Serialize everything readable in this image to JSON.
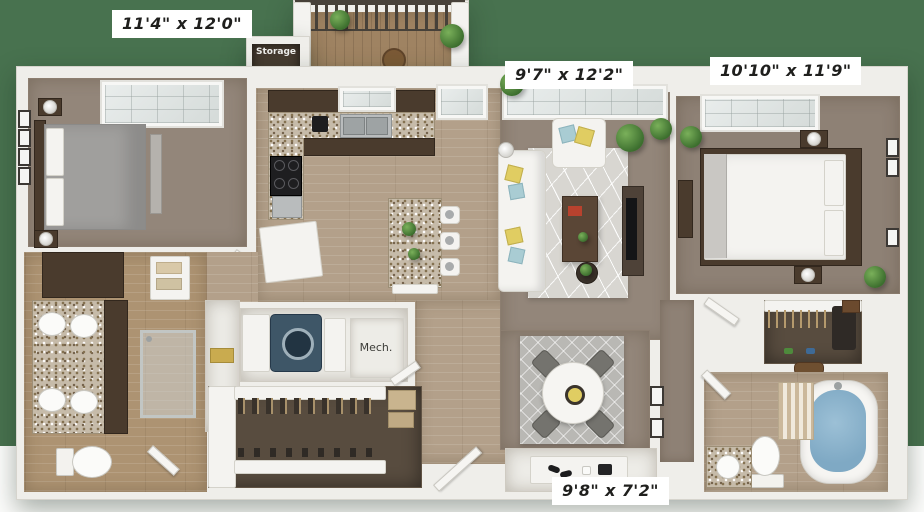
{
  "floorplan": {
    "rooms": {
      "bedroom1": {
        "dims": "11'4\" x 12'0\""
      },
      "living": {
        "dims": "9'7\" x 12'2\""
      },
      "bedroom2": {
        "dims": "10'10\" x 11'9\""
      },
      "dining": {
        "dims": "9'8\" x 7'2\""
      },
      "storage": {
        "label": "Storage"
      },
      "mechanical": {
        "label": "Mech."
      }
    },
    "colors": {
      "page_top": "#48724f",
      "page_bottom": "#fdfdfc",
      "wall": "#efeeea",
      "wood_floor": "#b3a08a",
      "carpet": "#93867a",
      "closet_carpet": "#584c3f",
      "cabinet_espresso": "#4a3b2d",
      "accent_pillow_yellow": "#e0cd62",
      "accent_pillow_teal": "#a9ccd3",
      "tub_water": "#7fa9c4",
      "plant_green": "#4e8a3c"
    }
  }
}
